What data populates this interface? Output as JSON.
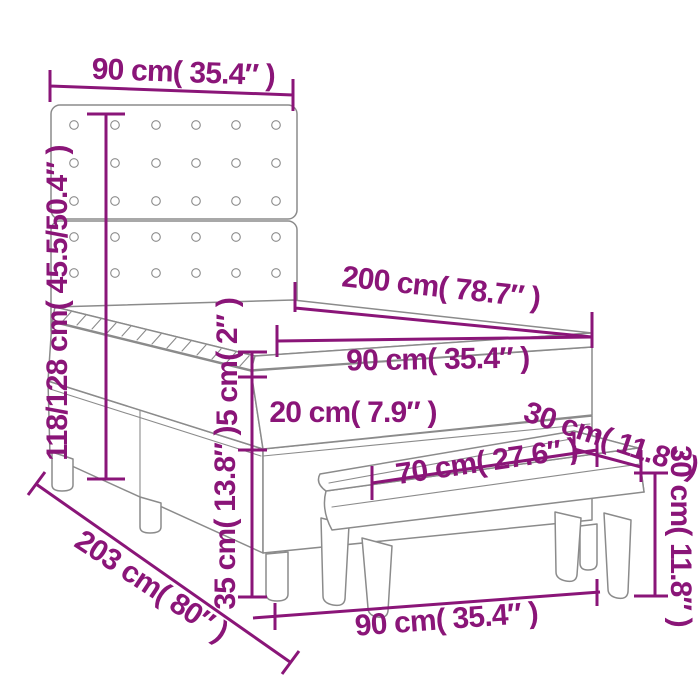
{
  "diagram": {
    "kind": "furniture-dimension-diagram",
    "subject": "Box spring bed with button-tufted headboard, mattress topper and bench",
    "colors": {
      "dimension_annotation": "#8a1578",
      "furniture_outline": "#8b8b8b",
      "background": "#ffffff"
    },
    "dimensions": {
      "headboard_width": "90 cm( 35.4″ )",
      "overall_height": "118/128 cm( 45.5/50.4″ )",
      "bed_length": "200 cm( 78.7″ )",
      "mattress_width": "90 cm( 35.4″ )",
      "topper_height": "5 cm( 2″ )",
      "mattress_height": "20 cm( 7.9″ )",
      "base_height": "35 cm( 13.8″ )",
      "overall_length": "203 cm( 80″ )",
      "base_width": "90 cm( 35.4″ )",
      "bench_length": "70 cm( 27.6″ )",
      "bench_depth": "30 cm( 11.8″ )",
      "bench_height": "30 cm( 11.8″ )"
    }
  }
}
